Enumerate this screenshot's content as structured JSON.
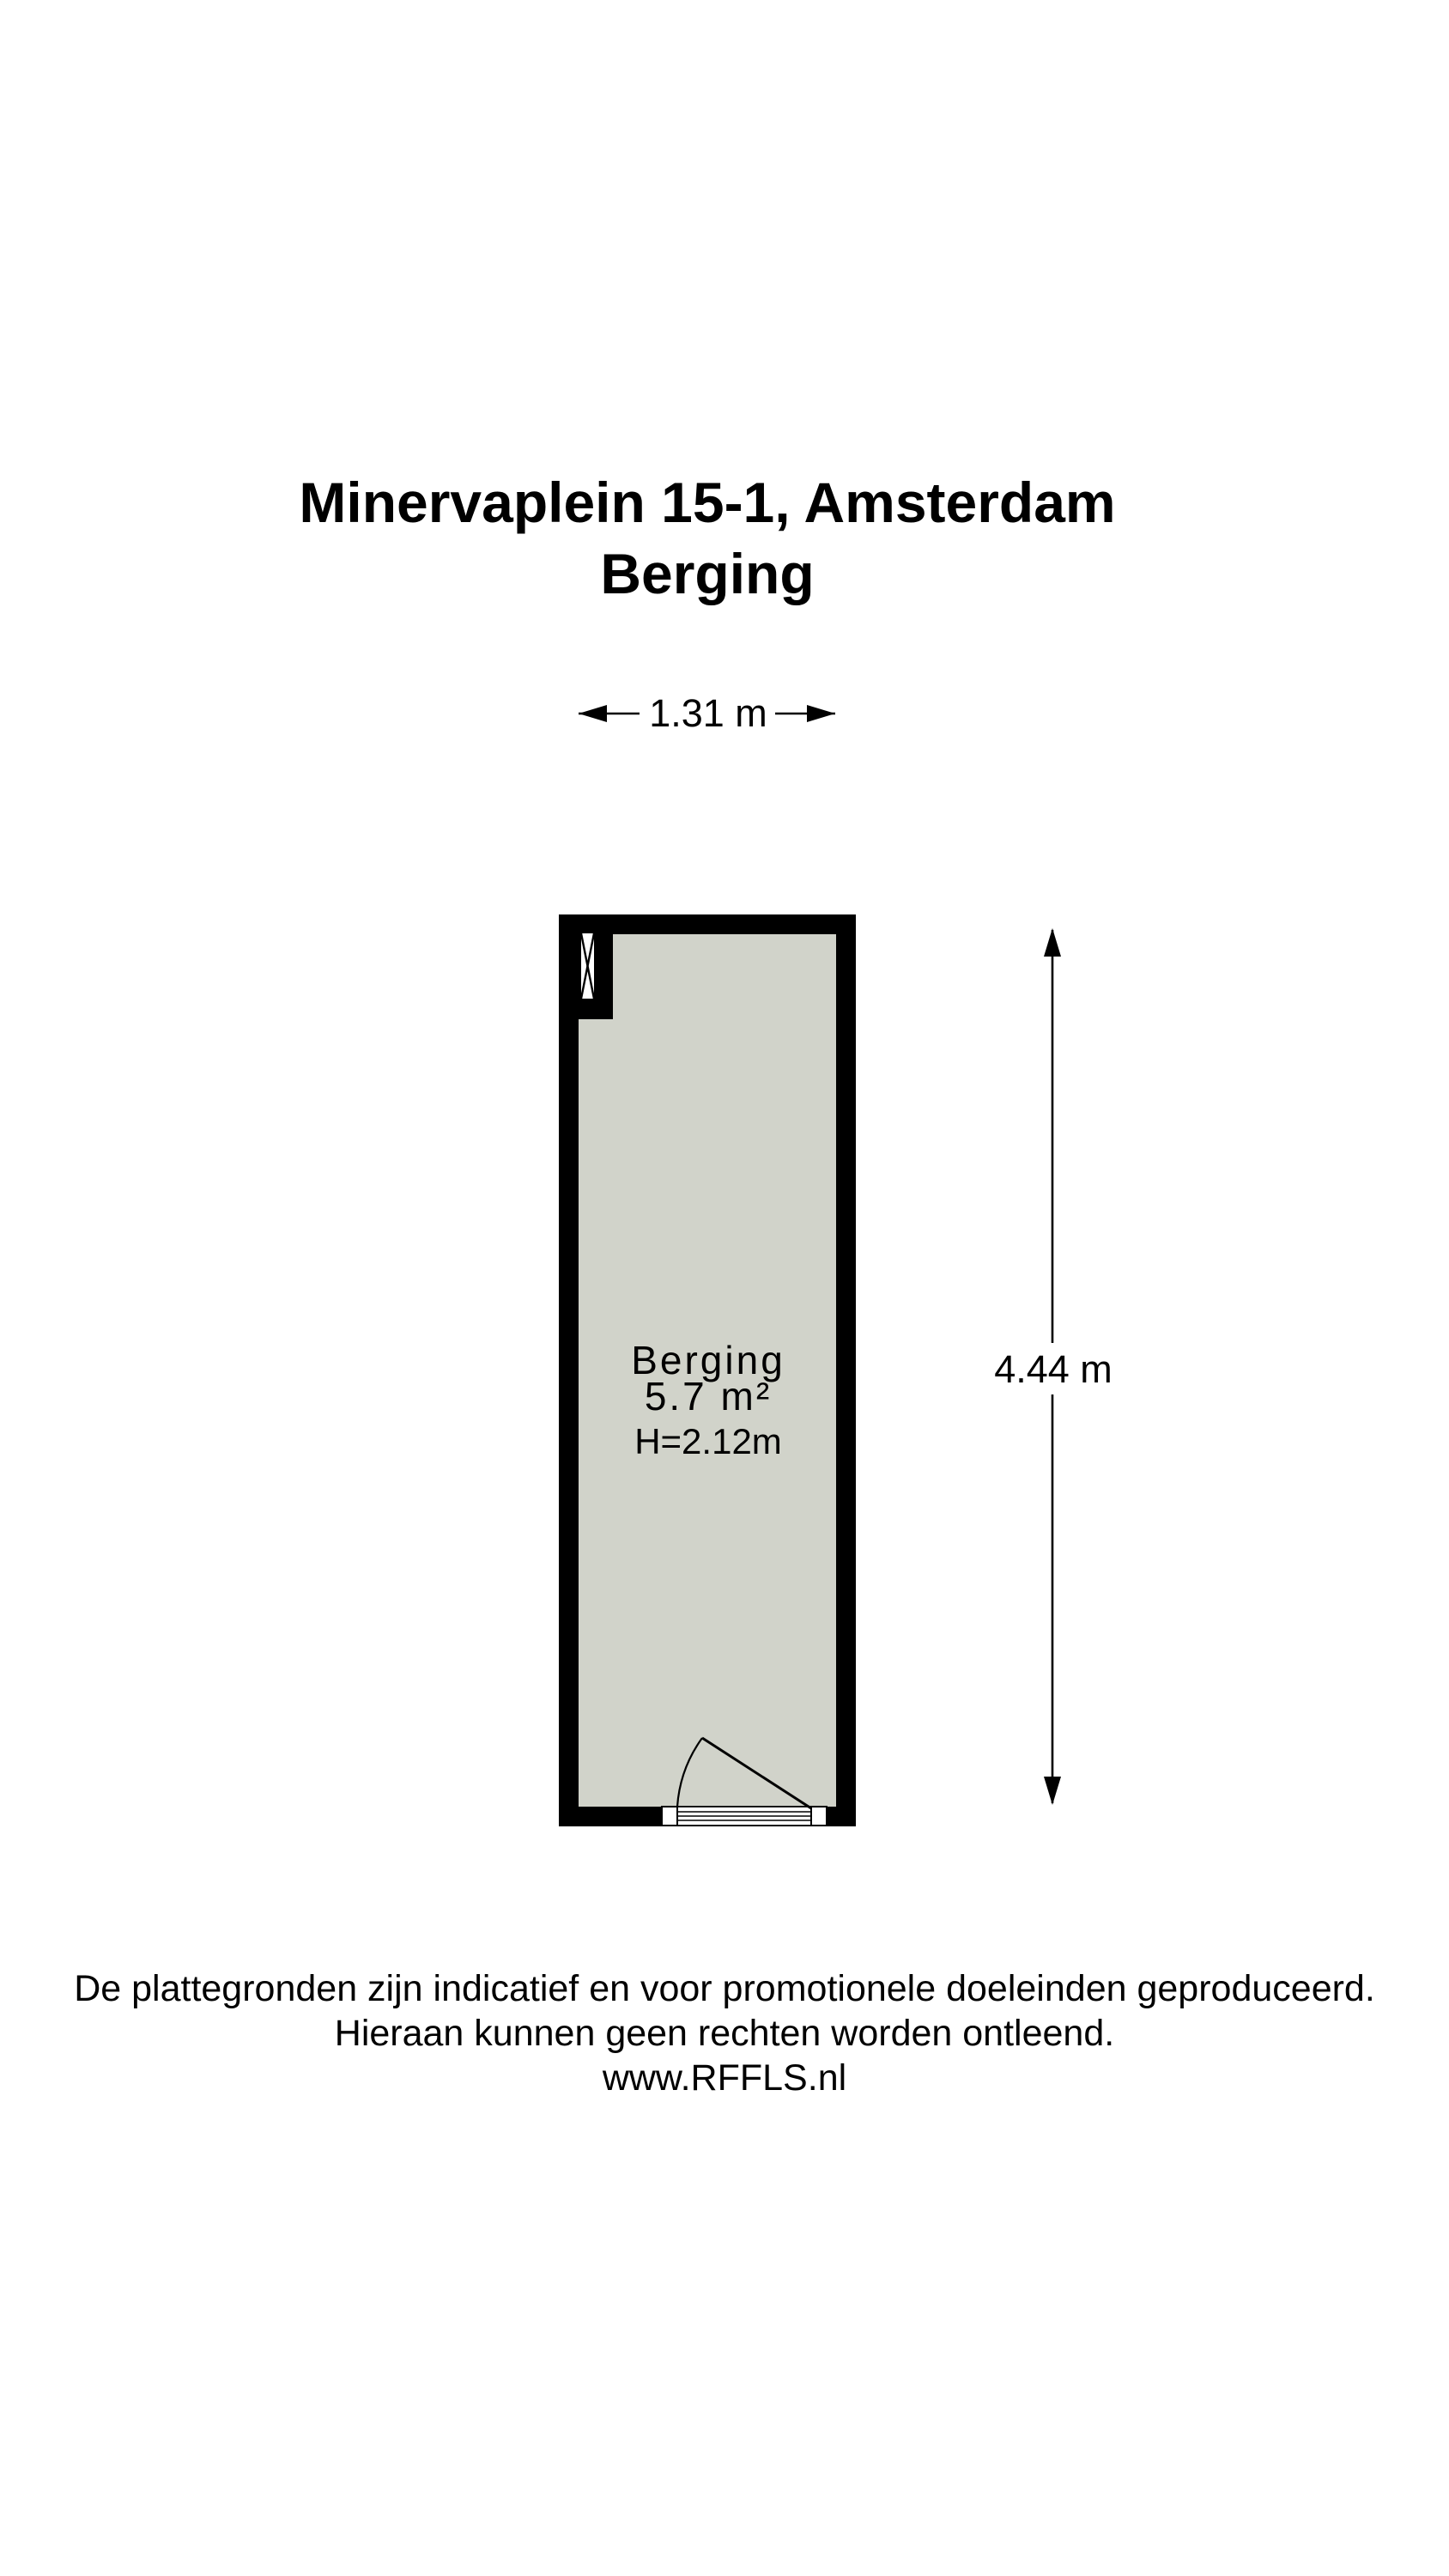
{
  "title": {
    "line1": "Minervaplein 15-1, Amsterdam",
    "line2": "Berging"
  },
  "dimensions": {
    "width_label": "1.31 m",
    "height_label": "4.44 m"
  },
  "room": {
    "name": "Berging",
    "area": "5.7 m²",
    "ceiling_height": "H=2.12m"
  },
  "footer": {
    "disclaimer_line1": "De plattegronden zijn indicatief en voor promotionele doeleinden geproduceerd.",
    "disclaimer_line2": "Hieraan kunnen geen rechten worden ontleend.",
    "website": "www.RFFLS.nl"
  },
  "colors": {
    "wall": "#000000",
    "floor": "#d1d3ca",
    "text": "#000000",
    "background": "#ffffff"
  }
}
